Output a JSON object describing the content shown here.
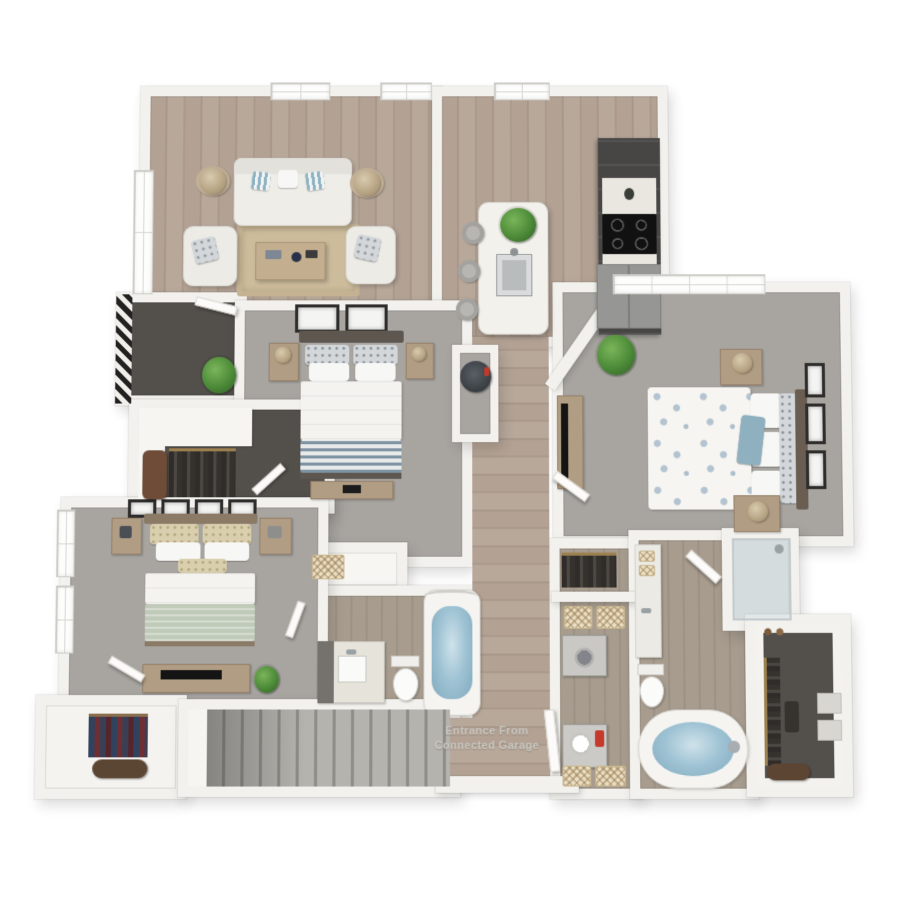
{
  "scene": {
    "kind": "3d-floorplan-render",
    "entrance_label": {
      "line1": "Entrance From",
      "line2": "Connected Garage"
    }
  },
  "palette": {
    "page_bg": "#ffffff",
    "wall": "#f2f1ed",
    "wood_floor": "#b0a093",
    "carpet": "#a8a5a1",
    "dark_floor": "#53504c",
    "cabinet_dark": "#474645",
    "counter_white": "#eae7e0",
    "tub_water_blue": "#9fc3d4",
    "accent_pillow_blue": "#8fb0bf",
    "sage_blanket": "#c0cab8",
    "plant_green": "#4c8a38",
    "detergent_red": "#c63a2b",
    "rug_tan": "#cdbc9c",
    "tv_black": "#141414"
  },
  "rooms": [
    {
      "id": "living-room",
      "floor": "wood",
      "furniture": [
        "sofa",
        "armchair-left",
        "armchair-right",
        "coffee-table",
        "area-rug",
        "floor-lamp-left",
        "floor-lamp-right",
        "top-windows",
        "side-windows"
      ]
    },
    {
      "id": "kitchen",
      "floor": "wood",
      "furniture": [
        "island",
        "island-sink",
        "island-plant",
        "barstools",
        "cabinet-run",
        "cooktop",
        "counters",
        "refrigerator",
        "window"
      ]
    },
    {
      "id": "balcony",
      "floor": "dark",
      "furniture": [
        "railing",
        "potted-plant",
        "door"
      ]
    },
    {
      "id": "front-walk-in-closet",
      "floor": "dark",
      "furniture": [
        "shelf",
        "hanging-clothes",
        "leather-bench"
      ]
    },
    {
      "id": "bedroom-middle",
      "floor": "carpet",
      "furniture": [
        "bed-striped-blanket",
        "nightstand-left",
        "nightstand-right",
        "lamps",
        "wall-art-pair",
        "dresser",
        "door"
      ]
    },
    {
      "id": "utility-closet",
      "floor": "carpet",
      "furniture": [
        "water-heater"
      ]
    },
    {
      "id": "primary-bedroom",
      "floor": "carpet",
      "furniture": [
        "bed-floral-duvet",
        "blue-accent-pillow",
        "nightstand-upper",
        "nightstand-lower",
        "lamps",
        "tv-console",
        "tv",
        "wall-art-trio",
        "potted-plant",
        "double-window",
        "door"
      ]
    },
    {
      "id": "bedroom-lower-left",
      "floor": "carpet",
      "furniture": [
        "bed-sage-blanket",
        "nightstand-left",
        "nightstand-right",
        "media-console",
        "tv",
        "wall-art-quad",
        "plant",
        "side-windows",
        "door"
      ]
    },
    {
      "id": "hall-bathroom",
      "floor": "wood-tile",
      "furniture": [
        "vanity",
        "sink",
        "toilet",
        "bathtub",
        "shower-curtain",
        "door"
      ]
    },
    {
      "id": "linen-closet",
      "floor": "shelf",
      "furniture": [
        "basket"
      ]
    },
    {
      "id": "entry-hall",
      "floor": "wood",
      "furniture": [
        "garage-entrance-door"
      ]
    },
    {
      "id": "laundry-room",
      "floor": "wood-tile",
      "furniture": [
        "hanging-clothes-closet",
        "shelf-baskets",
        "washer",
        "dryer",
        "detergent-bottle",
        "floor-baskets"
      ]
    },
    {
      "id": "primary-bathroom",
      "floor": "wood-tile",
      "furniture": [
        "vanity",
        "towels",
        "toilet",
        "soaking-tub",
        "door"
      ]
    },
    {
      "id": "walk-in-shower",
      "floor": "tile",
      "furniture": [
        "glass-enclosure",
        "shower-head"
      ]
    },
    {
      "id": "primary-closet",
      "floor": "dark",
      "furniture": [
        "hanging-clothes",
        "shoes",
        "storage-boxes",
        "bag"
      ]
    },
    {
      "id": "staircase",
      "floor": "stairs",
      "furniture": []
    },
    {
      "id": "coat-closet",
      "floor": "light",
      "furniture": [
        "hanging-coats",
        "duffel-bag"
      ]
    }
  ]
}
